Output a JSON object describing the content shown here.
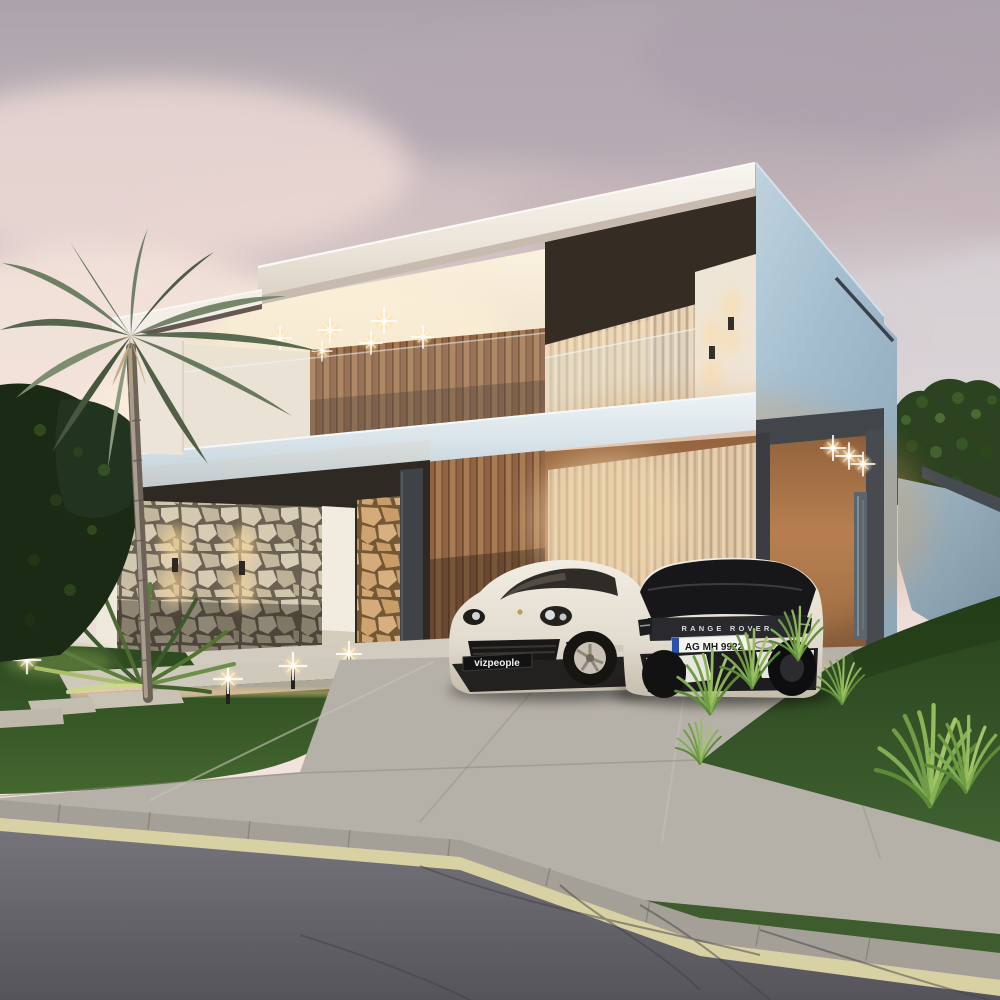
{
  "scene": {
    "setting": "modern two-story house exterior render at dusk",
    "watermark_plate_text": "vizpeople",
    "range_rover": {
      "tailgate_badge": "RANGE ROVER",
      "license_plate": "AG MH 9922",
      "plate_strip_color": "#2a4fae",
      "body_color": "#eae5da",
      "roof_color": "#161618"
    },
    "porsche": {
      "plate_text": "vizpeople",
      "body_color": "#eae4d8"
    },
    "lights": {
      "terrace_downlights": 6,
      "carport_downlights": 3,
      "stone_wall_sconces": 2,
      "balcony_wall_sconces": 2,
      "path_bollards": 3
    },
    "palette": {
      "sky_top": "#a9a1a8",
      "sky_pink": "#f2e2da",
      "sky_glow": "#fbeedd",
      "roof_white": "#f3efe8",
      "wall_blue": "#a6c0d0",
      "slab_blue": "#d8e4ea",
      "dark_trim": "#3f4347",
      "wood": "#a0744e",
      "ceiling_warm": "#f6ead8",
      "stone": "#cdc2aa",
      "stone_warm": "#cfa876",
      "curtain": "#dcc6a8",
      "lawn": "#3a5a2e",
      "hedge": "#2e4520",
      "driveway": "#b6b1a8",
      "road": "#6e6d71",
      "road_line": "#d8d1a4",
      "light_warm": "#ffd99b"
    }
  }
}
